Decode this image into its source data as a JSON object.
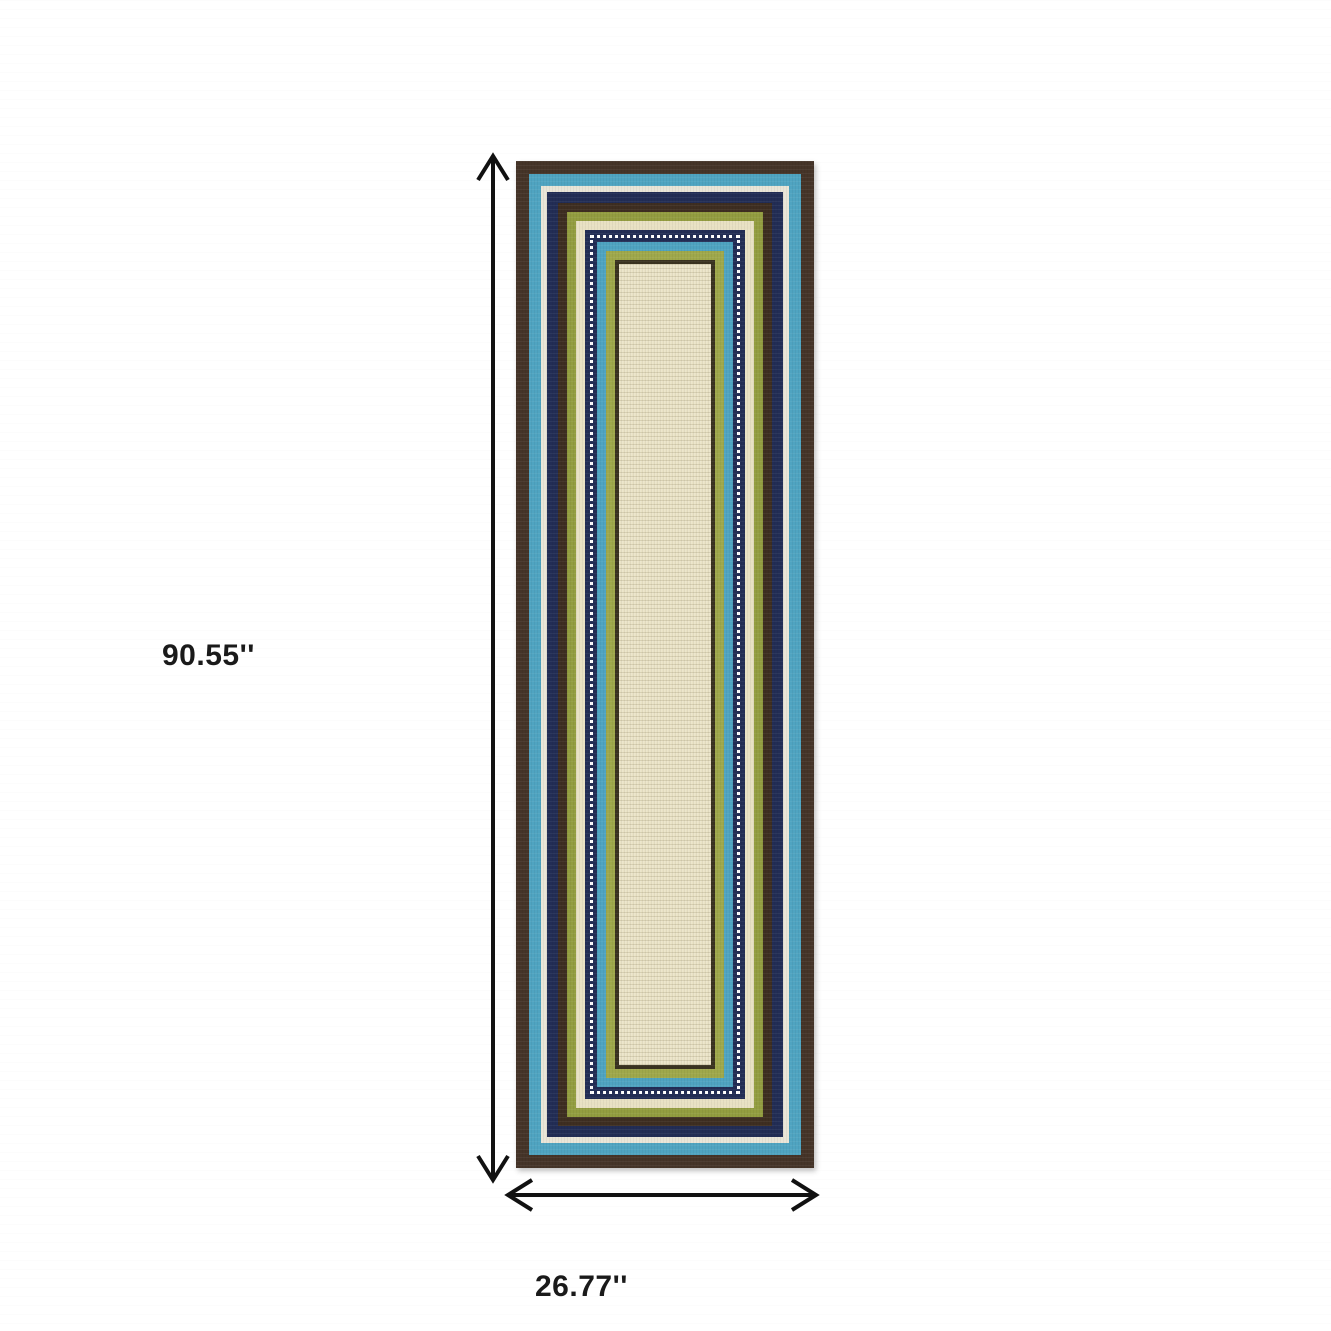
{
  "annotations": {
    "arrow_color": "#111111",
    "text_color": "#1a1a1a",
    "height_label": "90.55''",
    "width_label": "26.77''"
  },
  "rug": {
    "description": "ivory runner rug with concentric striped borders",
    "field_color": "#eae3c6",
    "layers": [
      {
        "name": "border-brown-outer",
        "color": "#453428",
        "width": 13
      },
      {
        "name": "border-teal-outer",
        "color": "#4fa4c1",
        "width": 12
      },
      {
        "name": "border-ivory-thin",
        "color": "#e9e5d7",
        "width": 6
      },
      {
        "name": "border-navy-outer",
        "color": "#222d55",
        "width": 11
      },
      {
        "name": "border-brown-middle",
        "color": "#3e2e21",
        "width": 9
      },
      {
        "name": "border-olive-green",
        "color": "#939d40",
        "width": 9
      },
      {
        "name": "border-cream",
        "color": "#e8e1c3",
        "width": 9
      },
      {
        "name": "border-navy-dotted",
        "color": "#222d55",
        "width": 12,
        "dotted": true,
        "dot_color": "#ffffff"
      },
      {
        "name": "border-teal-inner",
        "color": "#4fa4c1",
        "width": 9
      },
      {
        "name": "border-lime-green",
        "color": "#9fa84b",
        "width": 9
      },
      {
        "name": "border-dark-olive-thin",
        "color": "#3a3320",
        "width": 4
      }
    ]
  }
}
